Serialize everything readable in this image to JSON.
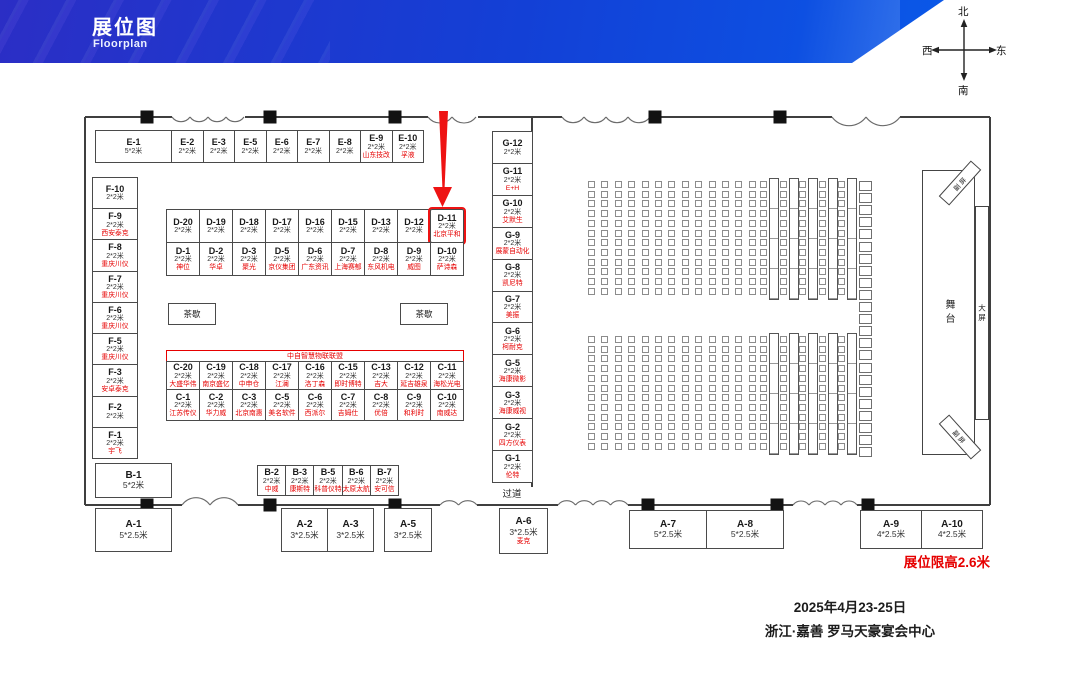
{
  "header": {
    "title": "展位图",
    "subtitle": "Floorplan"
  },
  "compass": {
    "north": "北",
    "south": "南",
    "west": "西",
    "east": "东"
  },
  "booths": {
    "e1": {
      "id": "E-1",
      "size": "5*2米"
    },
    "e_row": [
      {
        "id": "E-2",
        "size": "2*2米"
      },
      {
        "id": "E-3",
        "size": "2*2米"
      },
      {
        "id": "E-5",
        "size": "2*2米"
      },
      {
        "id": "E-6",
        "size": "2*2米"
      },
      {
        "id": "E-7",
        "size": "2*2米"
      },
      {
        "id": "E-8",
        "size": "2*2米"
      },
      {
        "id": "E-9",
        "size": "2*2米",
        "name": "山东技改"
      },
      {
        "id": "E-10",
        "size": "2*2米",
        "name": "孚液"
      }
    ],
    "f_col": [
      {
        "id": "F-10",
        "size": "2*2米"
      },
      {
        "id": "F-9",
        "size": "2*2米",
        "name": "西安泰克"
      },
      {
        "id": "F-8",
        "size": "2*2米",
        "name": "重庆川仪"
      },
      {
        "id": "F-7",
        "size": "2*2米",
        "name": "重庆川仪"
      },
      {
        "id": "F-6",
        "size": "2*2米",
        "name": "重庆川仪"
      },
      {
        "id": "F-5",
        "size": "2*2米",
        "name": "重庆川仪"
      },
      {
        "id": "F-3",
        "size": "2*2米",
        "name": "安卓泰克"
      },
      {
        "id": "F-2",
        "size": "2*2米"
      },
      {
        "id": "F-1",
        "size": "2*2米",
        "name": "宇飞"
      }
    ],
    "d_top": [
      {
        "id": "D-20",
        "size": "2*2米"
      },
      {
        "id": "D-19",
        "size": "2*2米"
      },
      {
        "id": "D-18",
        "size": "2*2米"
      },
      {
        "id": "D-17",
        "size": "2*2米"
      },
      {
        "id": "D-16",
        "size": "2*2米"
      },
      {
        "id": "D-15",
        "size": "2*2米"
      },
      {
        "id": "D-13",
        "size": "2*2米"
      },
      {
        "id": "D-12",
        "size": "2*2米"
      },
      {
        "id": "D-11",
        "size": "2*2米",
        "name": "北京平和",
        "highlight": true
      }
    ],
    "d_bottom": [
      {
        "id": "D-1",
        "size": "2*2米",
        "name": "神位"
      },
      {
        "id": "D-2",
        "size": "2*2米",
        "name": "华卓"
      },
      {
        "id": "D-3",
        "size": "2*2米",
        "name": "聚光"
      },
      {
        "id": "D-5",
        "size": "2*2米",
        "name": "京仪集团"
      },
      {
        "id": "D-6",
        "size": "2*2米",
        "name": "广东资讯"
      },
      {
        "id": "D-7",
        "size": "2*2米",
        "name": "上海赛郁"
      },
      {
        "id": "D-8",
        "size": "2*2米",
        "name": "东风机电"
      },
      {
        "id": "D-9",
        "size": "2*2米",
        "name": "威图"
      },
      {
        "id": "D-10",
        "size": "2*2米",
        "name": "萨诗森"
      }
    ],
    "c_header": "中自智慧物联联盟",
    "c_top": [
      {
        "id": "C-20",
        "size": "2*2米",
        "name": "大盛华伟"
      },
      {
        "id": "C-19",
        "size": "2*2米",
        "name": "南京盛亿"
      },
      {
        "id": "C-18",
        "size": "2*2米",
        "name": "中申仓"
      },
      {
        "id": "C-17",
        "size": "2*2米",
        "name": "江澜"
      },
      {
        "id": "C-16",
        "size": "2*2米",
        "name": "洛丁森"
      },
      {
        "id": "C-15",
        "size": "2*2米",
        "name": "即时博特"
      },
      {
        "id": "C-13",
        "size": "2*2米",
        "name": "吉大"
      },
      {
        "id": "C-12",
        "size": "2*2米",
        "name": "延吉雄泉"
      },
      {
        "id": "C-11",
        "size": "2*2米",
        "name": "海松光电"
      }
    ],
    "c_bottom": [
      {
        "id": "C-1",
        "size": "2*2米",
        "name": "江苏传仪"
      },
      {
        "id": "C-2",
        "size": "2*2米",
        "name": "华力威"
      },
      {
        "id": "C-3",
        "size": "2*2米",
        "name": "北京南惠"
      },
      {
        "id": "C-5",
        "size": "2*2米",
        "name": "美名软件"
      },
      {
        "id": "C-6",
        "size": "2*2米",
        "name": "西派尔"
      },
      {
        "id": "C-7",
        "size": "2*2米",
        "name": "吉姆仕"
      },
      {
        "id": "C-8",
        "size": "2*2米",
        "name": "优倍"
      },
      {
        "id": "C-9",
        "size": "2*2米",
        "name": "和利时"
      },
      {
        "id": "C-10",
        "size": "2*2米",
        "name": "南威达"
      }
    ],
    "g_col": [
      {
        "id": "G-12",
        "size": "2*2米"
      },
      {
        "id": "G-11",
        "size": "2*2米",
        "name": "E+H"
      },
      {
        "id": "G-10",
        "size": "2*2米",
        "name": "艾默生"
      },
      {
        "id": "G-9",
        "size": "2*2米",
        "name": "展蒙自动化"
      },
      {
        "id": "G-8",
        "size": "2*2米",
        "name": "凯尼特"
      },
      {
        "id": "G-7",
        "size": "2*2米",
        "name": "美振"
      },
      {
        "id": "G-6",
        "size": "2*2米",
        "name": "柯耐克"
      },
      {
        "id": "G-5",
        "size": "2*2米",
        "name": "海康微影"
      },
      {
        "id": "G-3",
        "size": "2*2米",
        "name": "海康威视"
      },
      {
        "id": "G-2",
        "size": "2*2米",
        "name": "四方仪表"
      },
      {
        "id": "G-1",
        "size": "2*2米",
        "name": "伦特"
      }
    ],
    "b1": {
      "id": "B-1",
      "size": "5*2米"
    },
    "a1": {
      "id": "A-1",
      "size": "5*2.5米"
    },
    "b_row": [
      {
        "id": "B-2",
        "size": "2*2米",
        "name": "中威"
      },
      {
        "id": "B-3",
        "size": "2*2米",
        "name": "康斯特"
      },
      {
        "id": "B-5",
        "size": "2*2米",
        "name": "科普仪特"
      },
      {
        "id": "B-6",
        "size": "2*2米",
        "name": "太原太航"
      },
      {
        "id": "B-7",
        "size": "2*2米",
        "name": "安可信"
      }
    ],
    "a23": [
      {
        "id": "A-2",
        "size": "3*2.5米"
      },
      {
        "id": "A-3",
        "size": "3*2.5米"
      }
    ],
    "a5": {
      "id": "A-5",
      "size": "3*2.5米"
    },
    "a6": {
      "id": "A-6",
      "size": "3*2.5米",
      "name": "麦克"
    },
    "a78": [
      {
        "id": "A-7",
        "size": "5*2.5米"
      },
      {
        "id": "A-8",
        "size": "5*2.5米"
      }
    ],
    "a910": [
      {
        "id": "A-9",
        "size": "4*2.5米"
      },
      {
        "id": "A-10",
        "size": "4*2.5米"
      }
    ]
  },
  "labels": {
    "tea_break": "茶歇",
    "aisle": "过道",
    "stage": "舞台",
    "big_screen": "大屏",
    "side_screen": "副屏",
    "height_limit": "展位限高2.6米"
  },
  "footer": {
    "date": "2025年4月23-25日",
    "venue": "浙江·嘉善 罗马天豪宴会中心"
  },
  "colors": {
    "accent_red": "#e60000",
    "banner_blue_left": "#2b2ec5",
    "banner_blue_right": "#0a58e8"
  }
}
